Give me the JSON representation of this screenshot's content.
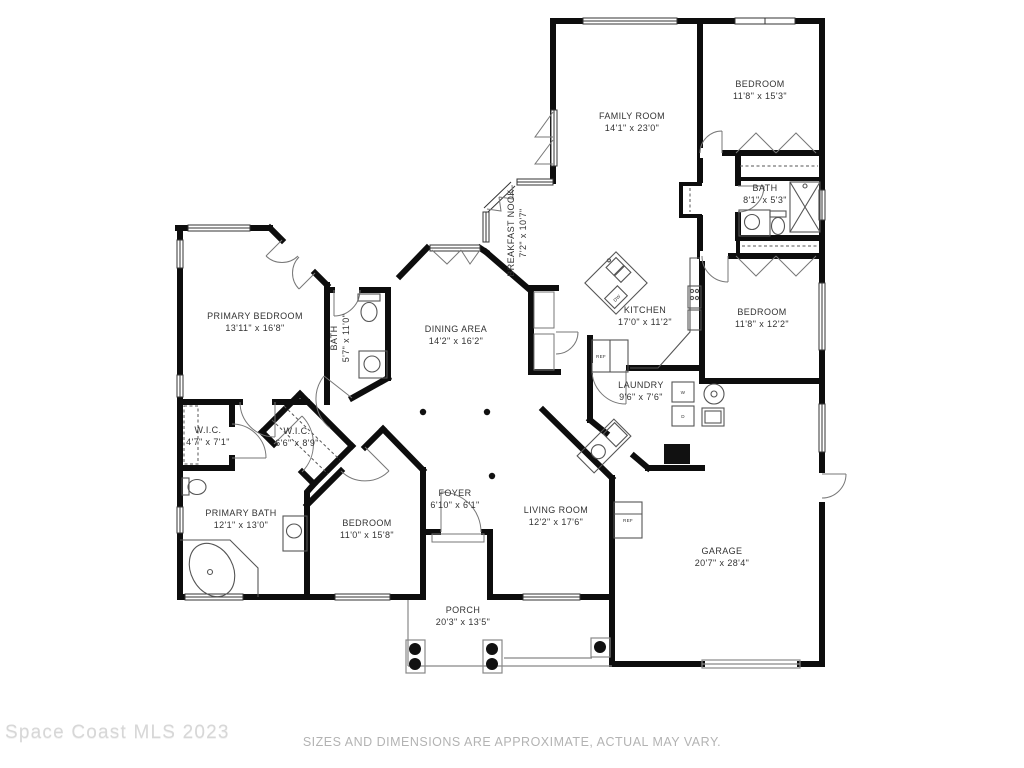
{
  "floor_plan": {
    "rooms": [
      {
        "name": "FAMILY ROOM",
        "dims": "14'1\" x 23'0\""
      },
      {
        "name": "BEDROOM",
        "dims": "11'8\" x 15'3\""
      },
      {
        "name": "BATH",
        "dims": "8'1\" x 5'3\""
      },
      {
        "name": "BREAKFAST NOOK",
        "dims": "7'2\" x 10'7\""
      },
      {
        "name": "KITCHEN",
        "dims": "17'0\" x 11'2\""
      },
      {
        "name": "BEDROOM",
        "dims": "11'8\" x 12'2\""
      },
      {
        "name": "PRIMARY BEDROOM",
        "dims": "13'11\" x 16'8\""
      },
      {
        "name": "BATH",
        "dims": "5'7\" x 11'0\""
      },
      {
        "name": "DINING AREA",
        "dims": "14'2\" x 16'2\""
      },
      {
        "name": "LAUNDRY",
        "dims": "9'6\" x 7'6\""
      },
      {
        "name": "W.I.C.",
        "dims": "4'7\" x 7'1\""
      },
      {
        "name": "W.I.C.",
        "dims": "6'6\" x 8'9\""
      },
      {
        "name": "PRIMARY BATH",
        "dims": "12'1\" x 13'0\""
      },
      {
        "name": "BEDROOM",
        "dims": "11'0\" x 15'8\""
      },
      {
        "name": "FOYER",
        "dims": "6'10\" x 6'1\""
      },
      {
        "name": "LIVING ROOM",
        "dims": "12'2\" x 17'6\""
      },
      {
        "name": "GARAGE",
        "dims": "20'7\" x 28'4\""
      },
      {
        "name": "PORCH",
        "dims": "20'3\" x 13'5\""
      }
    ],
    "appliances": {
      "refrigerator": "REF",
      "dishwasher": "DW",
      "washer": "W",
      "dryer": "D"
    },
    "watermark": "Space Coast MLS 2023",
    "disclaimer": "SIZES AND DIMENSIONS ARE APPROXIMATE, ACTUAL MAY VARY.",
    "colors": {
      "wall": "#0d0d0d",
      "label": "#333333",
      "fixture": "#555555",
      "watermark": "#d7d7d7",
      "disclaimer": "#b3b3b3"
    }
  }
}
